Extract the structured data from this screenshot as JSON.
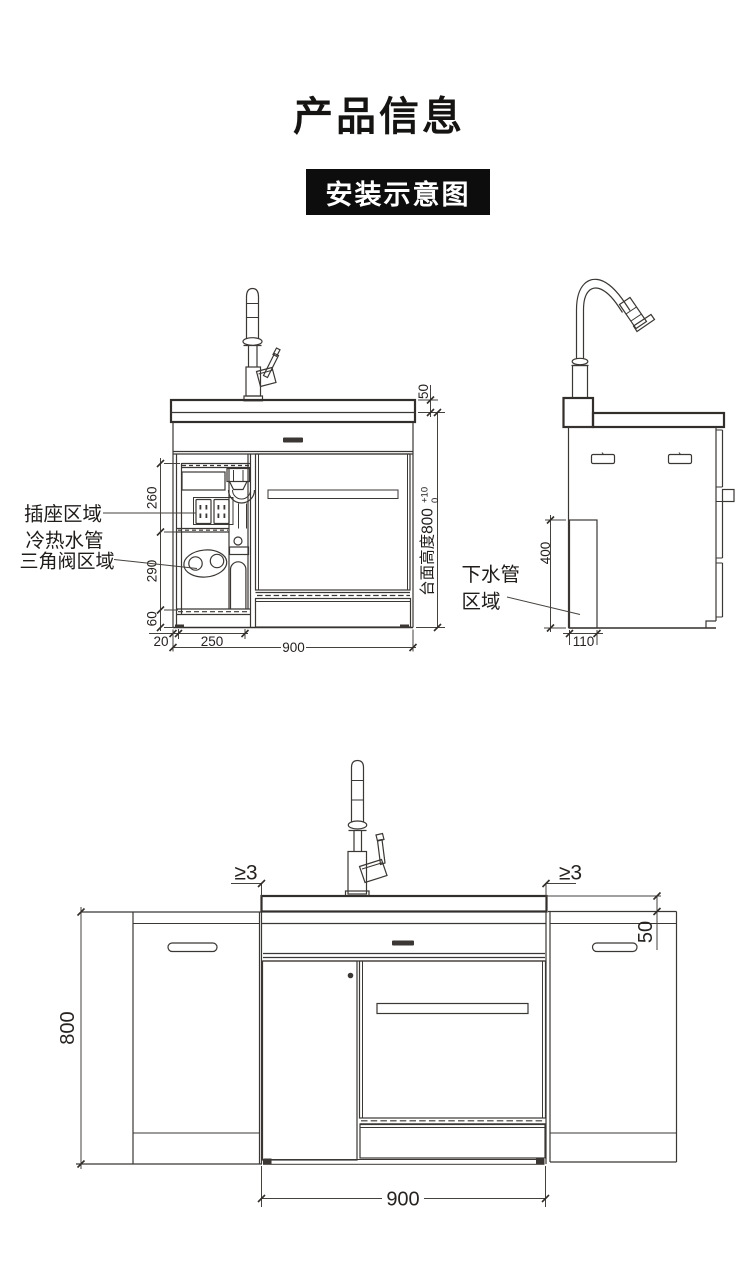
{
  "header": {
    "title": "产品信息",
    "badge": "安装示意图"
  },
  "front_view": {
    "annotations": {
      "socket_area": "插座区域",
      "hot_cold_pipes": "冷热水管",
      "valve_area": "三角阀区域",
      "counter_height_label": "台面高度800",
      "tol_upper": "+10",
      "tol_lower": "0"
    },
    "dimensions": {
      "top_zone_height": "260",
      "mid_zone_height": "290",
      "bottom_zone_height": "60",
      "left_offset": "20",
      "service_width": "250",
      "total_width": "900",
      "counter_thickness": "50"
    }
  },
  "side_view": {
    "annotations": {
      "drain_line1": "下水管",
      "drain_line2": "区域"
    },
    "dimensions": {
      "drain_zone_height": "400",
      "drain_zone_depth": "110"
    }
  },
  "bottom_view": {
    "dimensions": {
      "gap_left": "≥3",
      "gap_right": "≥3",
      "counter_drop": "50",
      "cabinet_height": "800",
      "total_width": "900"
    }
  },
  "colors": {
    "line": "#3b3734",
    "text": "#262220",
    "badge_bg": "#0d0d0d",
    "badge_text": "#ffffff",
    "background": "#ffffff"
  }
}
